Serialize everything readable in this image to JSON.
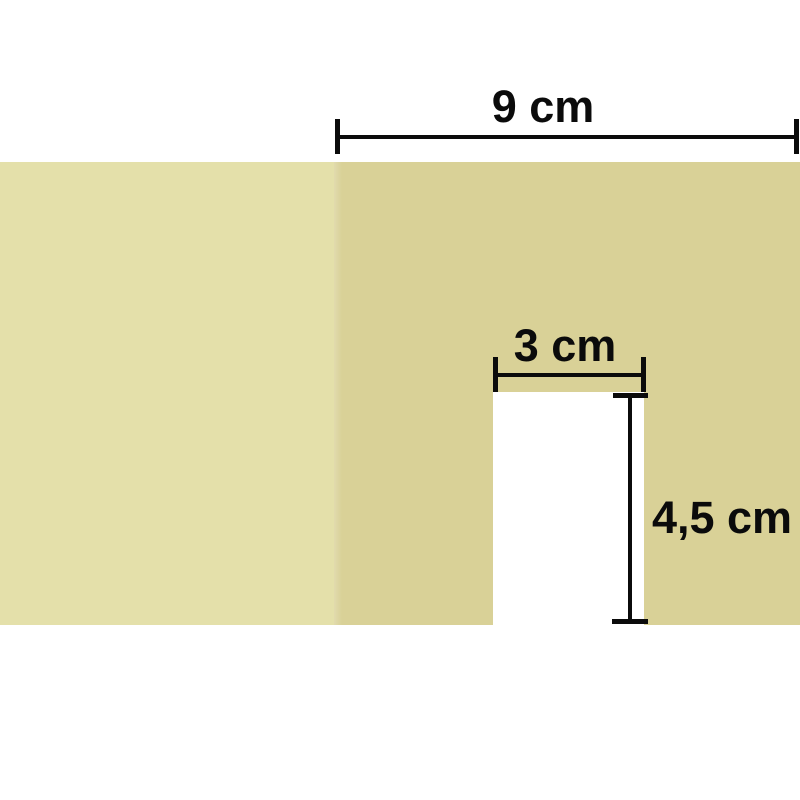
{
  "diagram": {
    "unit": "cm",
    "labels": {
      "top_width": "9 cm",
      "notch_width": "3 cm",
      "notch_height": "4,5 cm"
    },
    "dimensions": [
      {
        "id": "top-width",
        "label": "9 cm",
        "value_cm": 9,
        "orientation": "horizontal"
      },
      {
        "id": "notch-width",
        "label": "3 cm",
        "value_cm": 3,
        "orientation": "horizontal"
      },
      {
        "id": "notch-height",
        "label": "4,5 cm",
        "value_cm": 4.5,
        "orientation": "vertical"
      }
    ],
    "colors": {
      "panel_light": "#e4e0aa",
      "panel_dark": "#d9d197",
      "notch": "#ffffff",
      "background": "#ffffff",
      "line": "#0b0b0b"
    }
  }
}
